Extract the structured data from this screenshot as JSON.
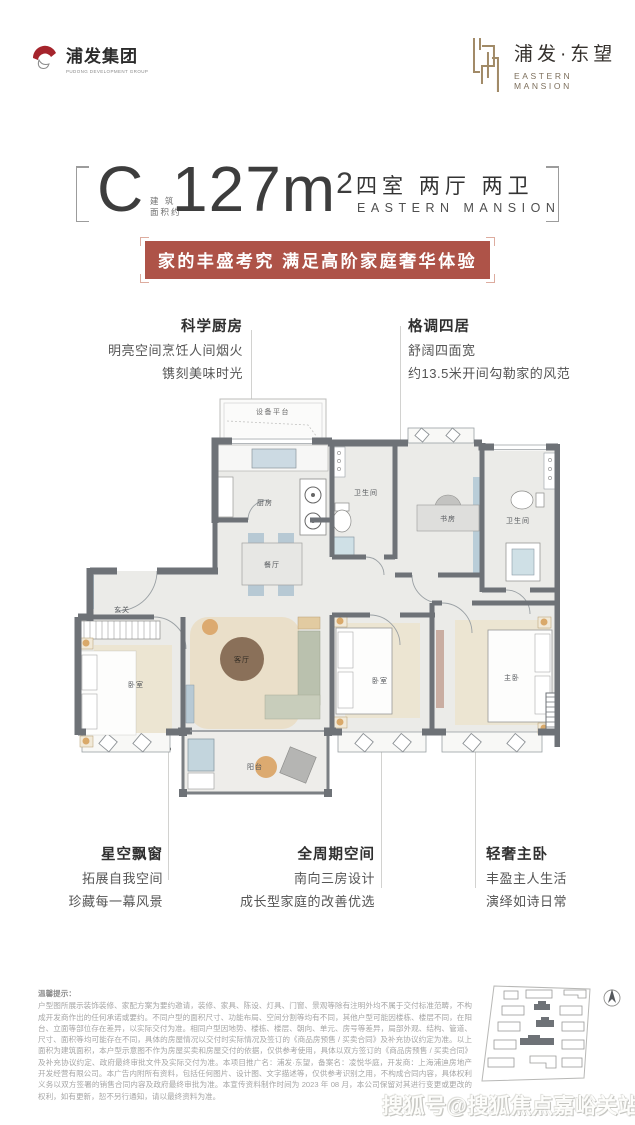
{
  "header": {
    "group_logo": {
      "text": "浦发集团",
      "sub": "PUDONG DEVELOPMENT GROUP",
      "accent": "#a5242c"
    },
    "project_logo": {
      "text": "浦发·东望",
      "sub": "EASTERN MANSION",
      "accent": "#a18a67"
    }
  },
  "title": {
    "unit": "C",
    "area_note1": "建 筑",
    "area_note2": "面积约",
    "area": "127m",
    "area_exp": "2",
    "layout": "四室 两厅 两卫",
    "layout_sub": "EASTERN MANSION"
  },
  "banner": {
    "text": "家的丰盛考究 满足高阶家庭奢华体验",
    "bg": "#ae5348"
  },
  "callouts": {
    "kitchen": {
      "title": "科学厨房",
      "line1": "明亮空间烹饪人间烟火",
      "line2": "镌刻美味时光"
    },
    "four_rooms": {
      "title": "格调四居",
      "line1": "舒阔四面宽",
      "line2": "约13.5米开间勾勒家的风范"
    },
    "bay_window": {
      "title": "星空飘窗",
      "line1": "拓展自我空间",
      "line2": "珍藏每一幕风景"
    },
    "full_cycle": {
      "title": "全周期空间",
      "line1": "南向三房设计",
      "line2": "成长型家庭的改善优选"
    },
    "master": {
      "title": "轻奢主卧",
      "line1": "丰盈主人生活",
      "line2": "演绎如诗日常"
    }
  },
  "floorplan": {
    "rooms": {
      "equipment_platform": "设备平台",
      "kitchen": "厨房",
      "bath1": "卫生间",
      "study": "书房",
      "bath2": "卫生间",
      "dining": "餐厅",
      "entry": "玄关",
      "bedroom1": "卧室",
      "living": "客厅",
      "bedroom2": "卧室",
      "master": "主卧",
      "balcony": "阳台"
    },
    "wall_color": "#6e7277",
    "floor_color": "#ebebe8"
  },
  "disclaimer": {
    "title": "温馨提示：",
    "body": "户型图所展示装饰装修、家配方案为要约邀请，装修、家具、陈设、灯具、门窗、景观等除有注明外均不属于交付标准范畴，不构成开发商作出的任何承诺或要约。不同户型的面积尺寸、功能布局、空间分割等均有不同，其他户型可能因楼栋、楼层不同，在阳台、立面等部位存在差异，以实际交付为准。相同户型因地势、楼栋、楼层、朝向、单元、房号等差异，局部外观、结构、管道、尺寸、面积等均可能存在不同，具体的房屋情况以交付时实际情况及签订的《商品房预售 / 买卖合同》及补充协议约定为准。以上面积为建筑面积，本户型示意图不作为房屋买卖和房屋交付的依据，仅供参考使用，具体以双方签订的《商品房预售 / 买卖合同》及补充协议约定、政府最终审批文件及实际交付为准。本项目推广名：浦发·东望，备案名：凌悦华庭，开发商：上海浦迪房地产开发经营有限公司。本广告内附所有资料，包括任何图片、设计图、文字描述等，仅供参考识别之用，不构成合同内容，具体权利义务以双方签署的销售合同内容及政府最终审批为准。本宣传资料制作时间为 2023 年 08 月，本公司保留对其进行变更或更改的权利，如有更新，恕不另行通知，请以最终资料为准。"
  },
  "watermark": {
    "text": "搜狐号@搜狐焦点嘉峪关站"
  }
}
